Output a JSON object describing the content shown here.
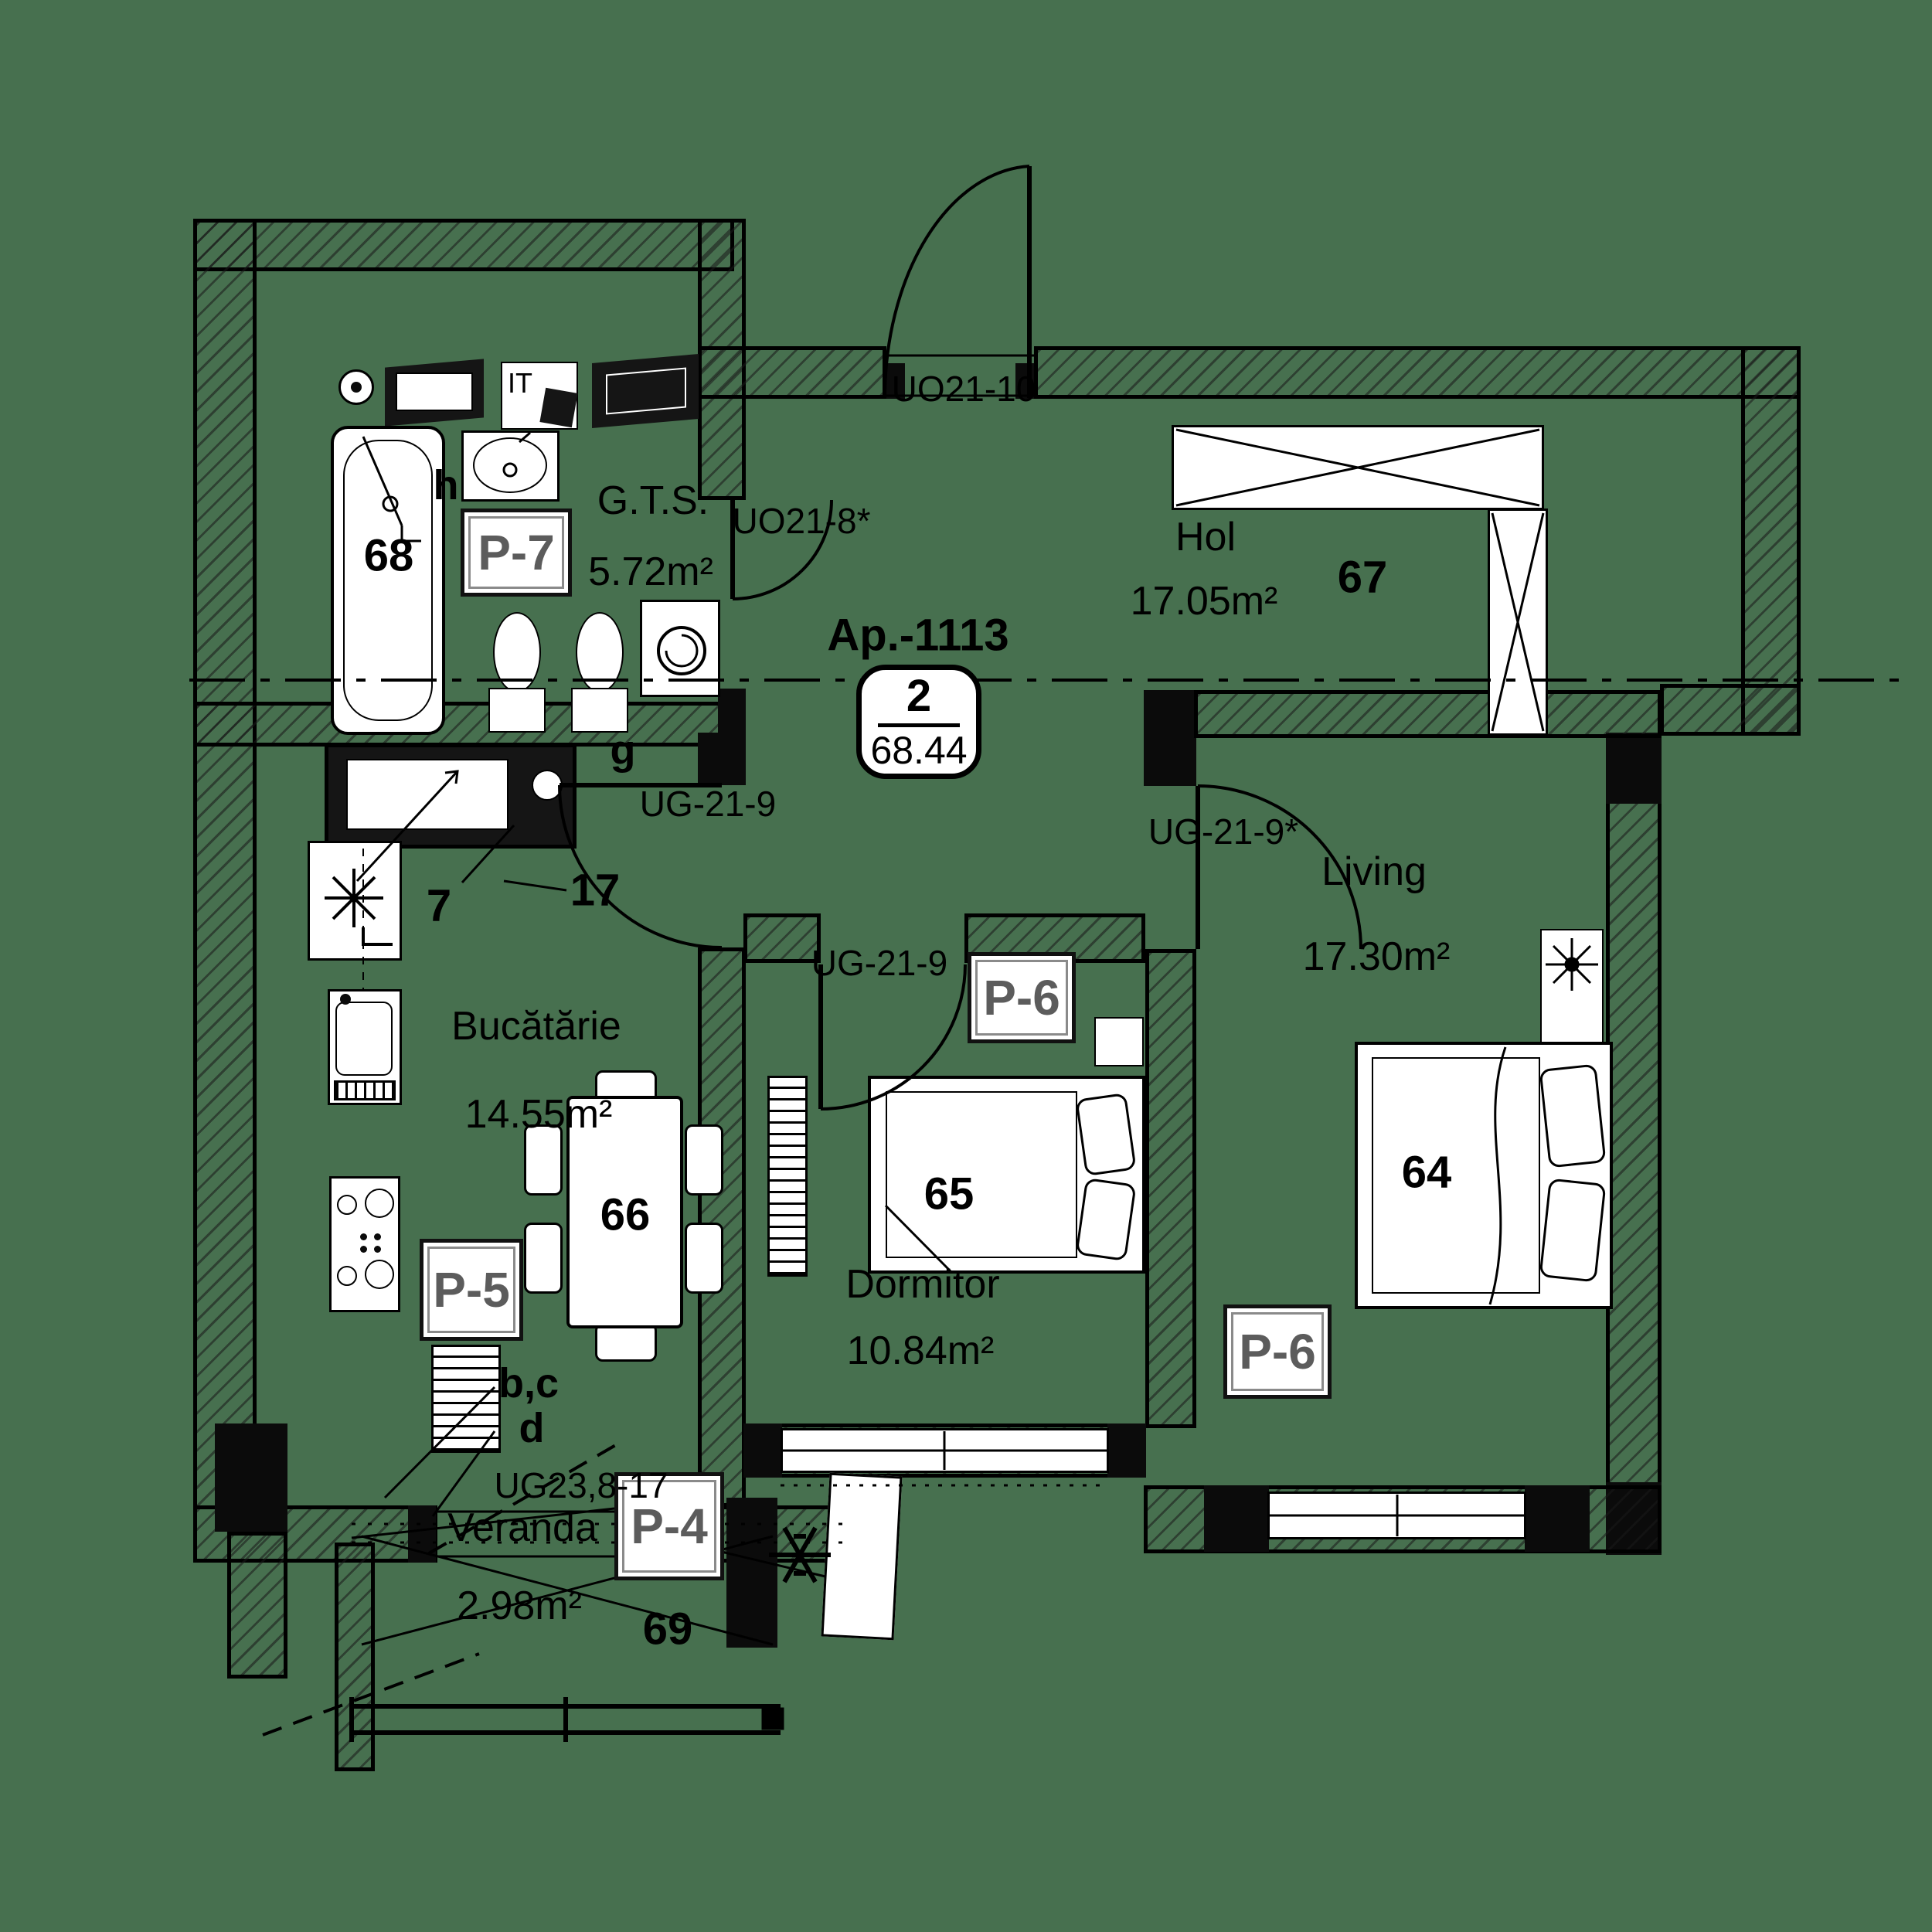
{
  "colors": {
    "background": "#47704f",
    "line": "#000000",
    "badge_text": "#5c5c5c",
    "fixture": "#ffffff"
  },
  "title": {
    "apartment": "Ap.-1113"
  },
  "unit_badge": {
    "rooms_count": "2",
    "total_area": "68.44"
  },
  "rooms": {
    "gts": {
      "name": "G.T.S.",
      "area": "5.72m²",
      "number": "68"
    },
    "hol": {
      "name": "Hol",
      "area": "17.05m²",
      "number": "67"
    },
    "kitchen": {
      "name": "Bucătărie",
      "area": "14.55m²",
      "number": "66"
    },
    "bedroom": {
      "name": "Dormitor",
      "area": "10.84m²",
      "number": "65"
    },
    "living": {
      "name": "Living",
      "area": "17.30m²",
      "number": "64"
    },
    "veranda": {
      "name": "Veranda",
      "area": "2.98m²",
      "number": "69"
    }
  },
  "doors": {
    "entrance": "UO21-10",
    "gts": "UO21-8*",
    "kitchen": "UG-21-9",
    "bedroom": "UG-21-9",
    "living": "UG-21-9*",
    "veranda": "UG23,8-17"
  },
  "window_tags": {
    "p4": "P-4",
    "p5": "P-5",
    "p6_bedroom": "P-6",
    "p6_living": "P-6",
    "p7": "P-7"
  },
  "annotations": {
    "it": "IT",
    "h": "h",
    "g": "g",
    "seven": "7",
    "seventeen": "17",
    "bc": "b,c",
    "d": "d"
  }
}
